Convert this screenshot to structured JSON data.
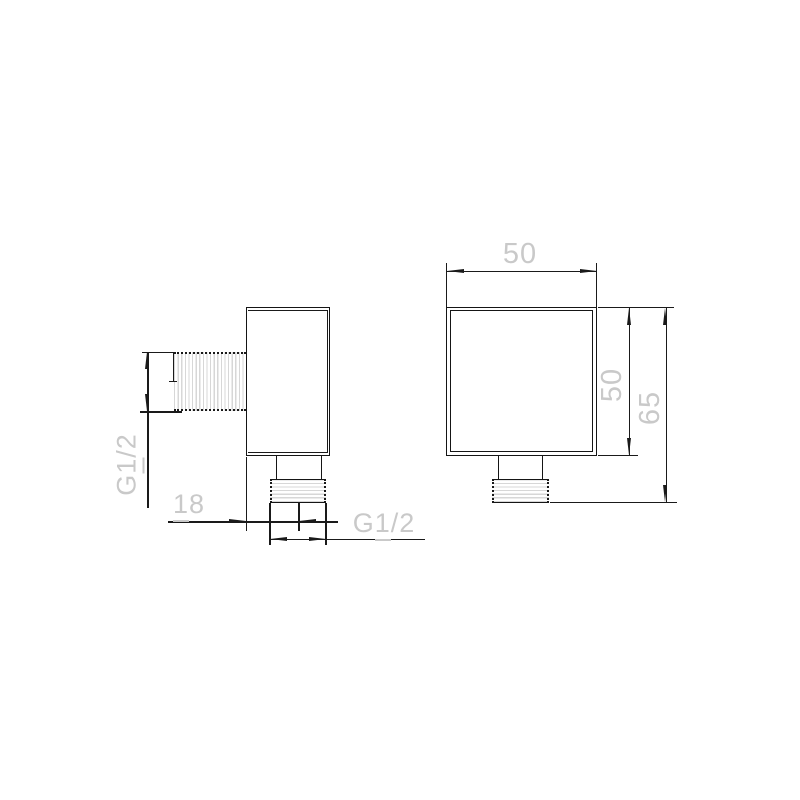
{
  "drawing": {
    "side_view": {
      "inlet_thread_label": "G1/2",
      "offset_label": "18",
      "outlet_thread_label": "G1/2"
    },
    "front_view": {
      "width_label": "50",
      "height_label": "50",
      "overall_height_label": "65"
    }
  },
  "colors": {
    "background": "#ffffff",
    "object_line": "#151515",
    "dimension_line": "#1a1a1a",
    "dimension_text": "#c9c9c9",
    "thread_hatch": "#d7d7d7"
  }
}
